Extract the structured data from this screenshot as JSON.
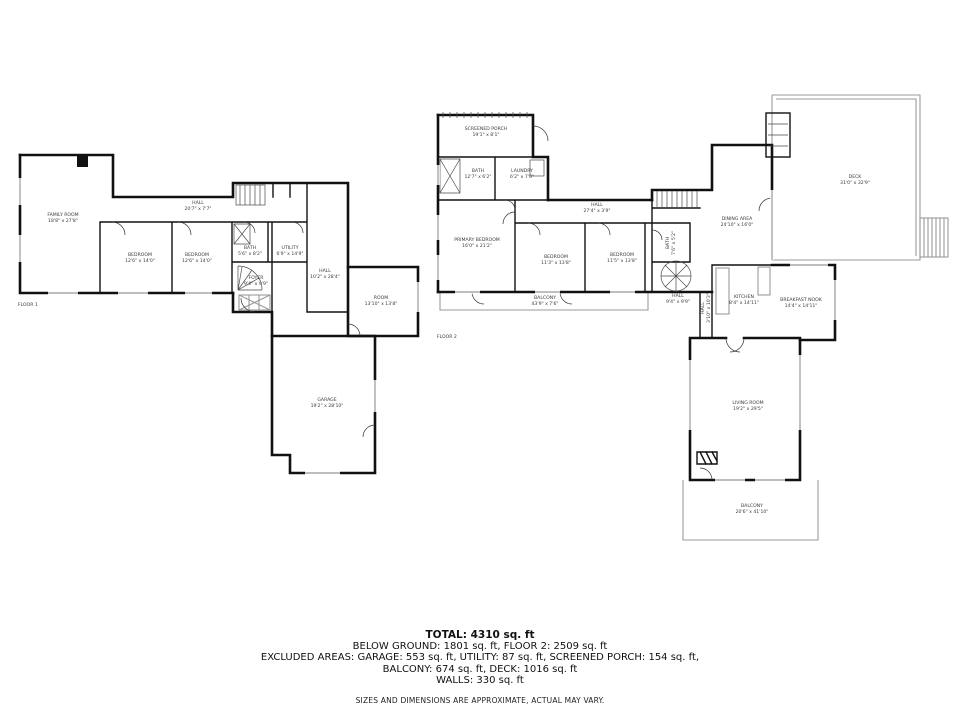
{
  "meta": {
    "background_color": "#ffffff",
    "wall_color": "#111111",
    "secondary_line_color": "#9a9a9a"
  },
  "floor1": {
    "label": "FLOOR 1",
    "rooms": {
      "family_room": {
        "name": "FAMILY ROOM",
        "dims": "18'8\" x 27'8\""
      },
      "hall_upper": {
        "name": "HALL",
        "dims": "20'7\" x 7'7\""
      },
      "bedroom_left": {
        "name": "BEDROOM",
        "dims": "12'6\" x 14'0\""
      },
      "bedroom_right": {
        "name": "BEDROOM",
        "dims": "12'6\" x 14'0\""
      },
      "bath": {
        "name": "BATH",
        "dims": "5'6\" x 8'2\""
      },
      "utility": {
        "name": "UTILITY",
        "dims": "6'9\" x 14'9\""
      },
      "foyer": {
        "name": "FOYER",
        "dims": "9'4\" x 9'9\""
      },
      "hall_lower": {
        "name": "HALL",
        "dims": "10'2\" x 28'4\""
      },
      "room": {
        "name": "ROOM",
        "dims": "13'10\" x 13'8\""
      },
      "garage": {
        "name": "GARAGE",
        "dims": "19'2\" x 28'10\""
      }
    }
  },
  "floor2": {
    "label": "FLOOR 2",
    "rooms": {
      "screened_porch": {
        "name": "SCREENED PORCH",
        "dims": "19'1\" x 8'1\""
      },
      "bath_upper": {
        "name": "BATH",
        "dims": "12'7\" x 6'2\""
      },
      "laundry": {
        "name": "LAUNDRY",
        "dims": "6'2\" x 7'0\""
      },
      "primary_bedroom": {
        "name": "PRIMARY BEDROOM",
        "dims": "16'0\" x 21'2\""
      },
      "hall_top": {
        "name": "HALL",
        "dims": "27'4\" x 3'9\""
      },
      "bedroom_left": {
        "name": "BEDROOM",
        "dims": "11'3\" x 13'8\""
      },
      "bedroom_right": {
        "name": "BEDROOM",
        "dims": "11'5\" x 13'8\""
      },
      "bath_small": {
        "name": "BATH",
        "dims": "7'6\" x 5'2\""
      },
      "balcony_rear": {
        "name": "BALCONY",
        "dims": "43'9\" x 7'6\""
      },
      "hall_stairs": {
        "name": "HALL",
        "dims": "9'4\" x 9'9\""
      },
      "hall_vertical": {
        "name": "HALL",
        "dims": "3'10\" x 10'3\""
      },
      "dining_area": {
        "name": "DINING AREA",
        "dims": "24'10\" x 16'0\""
      },
      "deck": {
        "name": "DECK",
        "dims": "31'0\" x 32'9\""
      },
      "kitchen": {
        "name": "KITCHEN",
        "dims": "8'4\" x 14'11\""
      },
      "breakfast_nook": {
        "name": "BREAKFAST NOOK",
        "dims": "14'4\" x 14'11\""
      },
      "living_room": {
        "name": "LIVING ROOM",
        "dims": "19'2\" x 29'5\""
      },
      "balcony_front": {
        "name": "BALCONY",
        "dims": "20'6\" x 41'10\""
      }
    }
  },
  "summary": {
    "total": "TOTAL: 4310 sq. ft",
    "line2": "BELOW GROUND: 1801 sq. ft, FLOOR 2: 2509 sq. ft",
    "line3": "EXCLUDED AREAS: GARAGE: 553 sq. ft, UTILITY: 87 sq. ft, SCREENED PORCH: 154 sq. ft,",
    "line4": "BALCONY: 674 sq. ft, DECK: 1016 sq. ft",
    "line5": "WALLS: 330 sq. ft",
    "disclaimer": "SIZES AND DIMENSIONS ARE APPROXIMATE, ACTUAL MAY VARY."
  }
}
